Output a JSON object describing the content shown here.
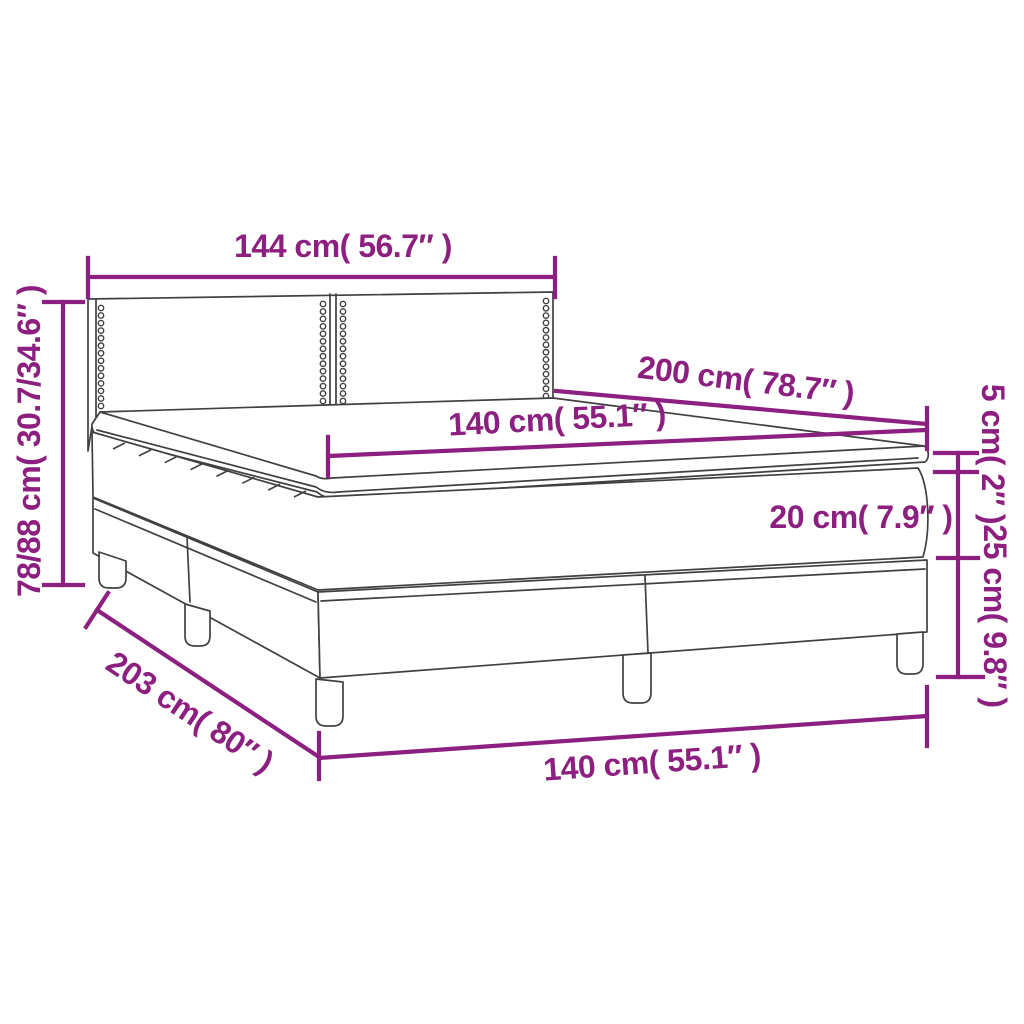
{
  "diagram": {
    "subject": "box-spring-bed-with-topper-dimension-diagram",
    "accent_color": "#8C1F7F",
    "line_color": "#404040",
    "background_color": "#ffffff",
    "labels": {
      "headboard_width": "144 cm( 56.7″ )",
      "total_height": "78/88 cm( 30.7/34.6″ )",
      "length": "200 cm( 78.7″ )",
      "mattress_width": "140 cm( 55.1″ )",
      "topper_thickness": "5 cm( 2″ )",
      "mattress_thickness": "20 cm( 7.9″ )",
      "base_height": "25 cm( 9.8″ )",
      "base_width": "140 cm( 55.1″ )",
      "total_length": "203 cm( 80″ )"
    }
  }
}
